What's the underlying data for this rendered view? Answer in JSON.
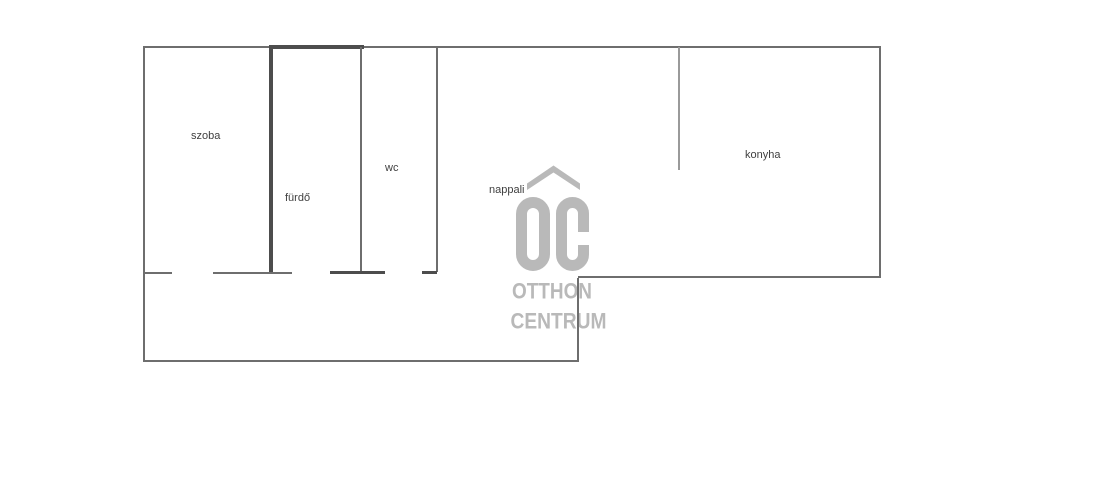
{
  "plan": {
    "rooms": {
      "szoba": "szoba",
      "furdo": "fürdő",
      "wc": "wc",
      "nappali": "nappali",
      "konyha": "konyha"
    },
    "watermark": {
      "brand": "OC",
      "line1": "OTTHON",
      "line2": "CENTRUM"
    },
    "colors": {
      "wall": "#6e6e6e",
      "wall_dark": "#4d4d4d",
      "wall_light": "#9a9a9a",
      "label": "#3f3f3f",
      "watermark": "#b9b9b9"
    }
  }
}
